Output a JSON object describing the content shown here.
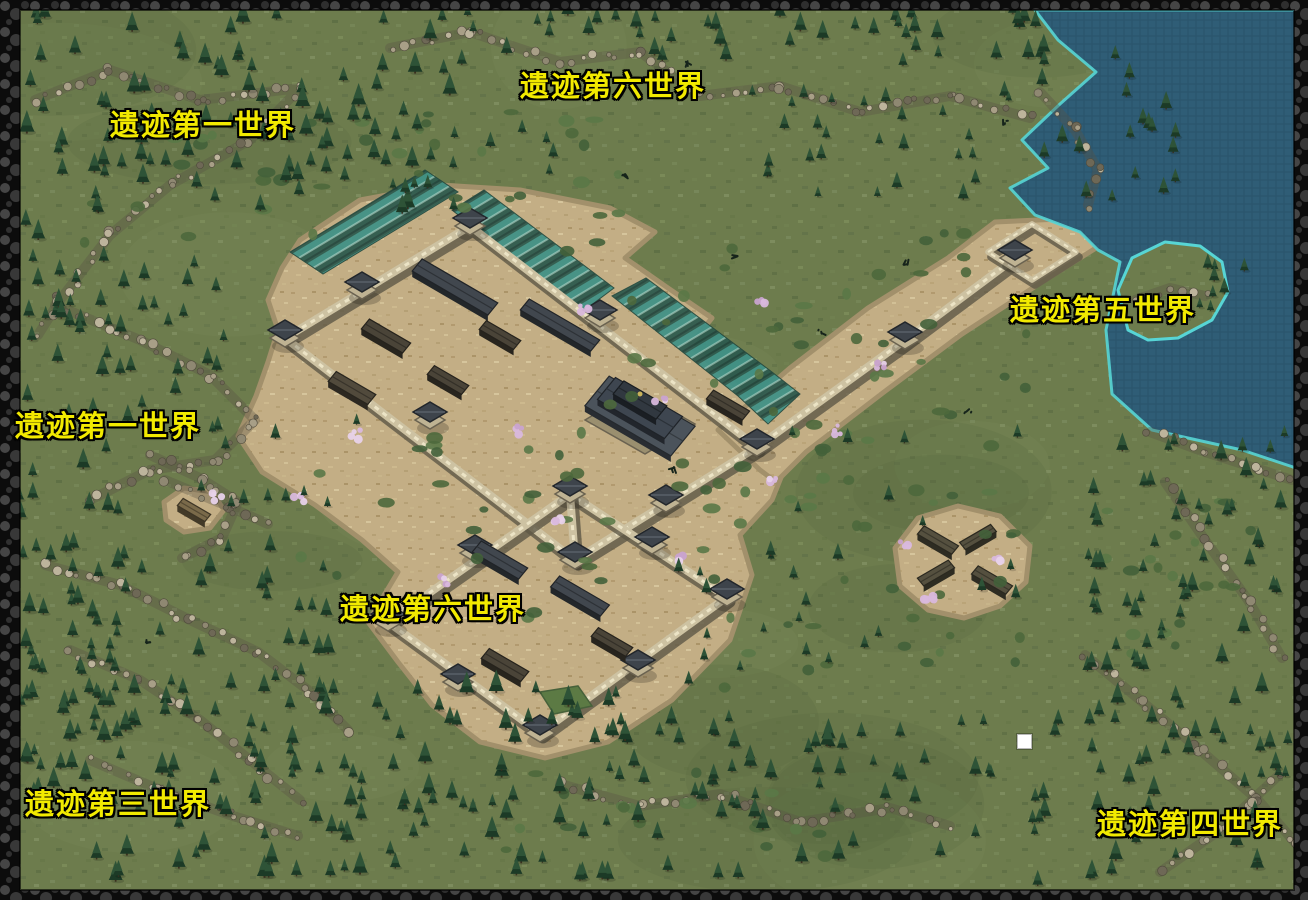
{
  "map": {
    "title": "ruins-world-overview-map",
    "labels": [
      {
        "id": "world6-top",
        "text": "遗迹第六世界",
        "x": 520,
        "y": 72
      },
      {
        "id": "world1-top-left",
        "text": "遗迹第一世界",
        "x": 110,
        "y": 111
      },
      {
        "id": "world5-right",
        "text": "遗迹第五世界",
        "x": 1010,
        "y": 296
      },
      {
        "id": "world1-left",
        "text": "遗迹第一世界",
        "x": 15,
        "y": 412
      },
      {
        "id": "world6-center",
        "text": "遗迹第六世界",
        "x": 340,
        "y": 595
      },
      {
        "id": "world3-bottom-left",
        "text": "遗迹第三世界",
        "x": 25,
        "y": 790
      },
      {
        "id": "world4-bottom-right",
        "text": "遗迹第四世界",
        "x": 1097,
        "y": 810
      }
    ],
    "player_marker": {
      "x": 1017,
      "y": 734,
      "size": 13,
      "color": "#ffffff"
    },
    "colors": {
      "grass": "#6d7c4d",
      "water": "#2f5d76",
      "shore": "#57d5d5",
      "dirt": "#c3ae85",
      "wall_stone": "#cdc2a2",
      "roof_dark": "#3e444b",
      "field_teal": "#3f9287",
      "rock": "#958f7c",
      "tree": "#234a2e",
      "blossom": "#d9b8dd",
      "border": "#0c0c0c",
      "label_fill": "#f2ea00",
      "label_outline": "#000000"
    }
  }
}
